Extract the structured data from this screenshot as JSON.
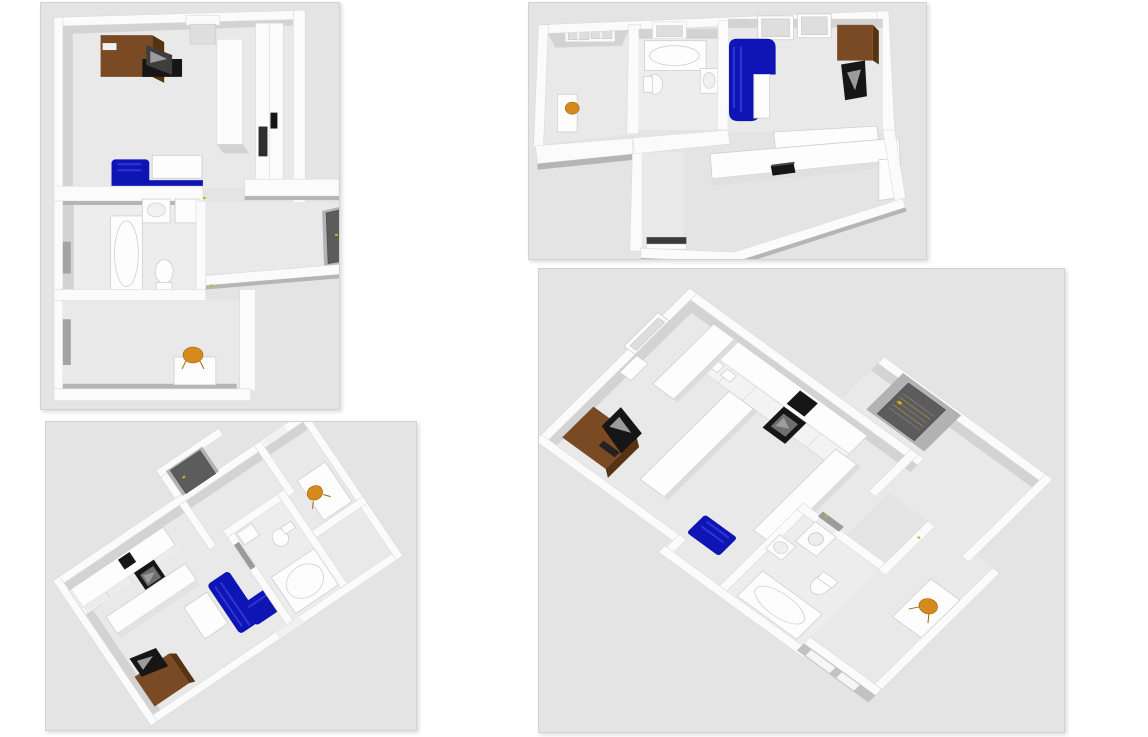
{
  "canvas": {
    "background": "#ffffff"
  },
  "colors": {
    "page_bg": "#ffffff",
    "panel_bg": "#e4e4e4",
    "panel_border": "#d2d2d2",
    "floor": "#e9e9e9",
    "wall": "#fbfbfb",
    "shade": "#d3d3d3",
    "shade_dark": "#b5b5b5",
    "sofa_blue": "#0f14b4",
    "sofa_blue_light": "#2a36d6",
    "wood_brown": "#7a4a24",
    "wood_brown_dark": "#563311",
    "black": "#161616",
    "screen_gray": "#9c9c9c",
    "chair_orange": "#d8891c",
    "door_dark": "#5c5c5c",
    "door_gray": "#9b9b9b",
    "accent_yellow": "#d8b400"
  },
  "panels": [
    {
      "name": "floor-plan-top-left",
      "label": "3D floor plan render, top-down view: office room with desk and computer, wardrobe, blue corner sofa, bathroom with bathtub, sink and toilet, lower room with desk and orange chair",
      "items": [
        "desk",
        "computer-monitor",
        "wardrobe",
        "cabinet-column",
        "blue-corner-sofa",
        "bathtub",
        "sink",
        "washing-machine",
        "toilet",
        "dark-panel-door",
        "desk-with-orange-chair",
        "window"
      ]
    },
    {
      "name": "floor-plan-top-right",
      "label": "3D floor plan render, wide top-down view: bedroom with desk and orange chair, bathroom with bathtub, toilet and sink, living room with blue corner sofa, brown wardrobe and TV, kitchen counters with black laptop, hallway",
      "items": [
        "window",
        "desk-with-orange-chair",
        "bathtub",
        "toilet",
        "sink",
        "blue-corner-sofa",
        "white-table",
        "brown-wardrobe",
        "tv",
        "kitchen-counter",
        "black-laptop",
        "hallway-door"
      ]
    },
    {
      "name": "floor-plan-bottom-left",
      "label": "3D floor plan render, rotated view: kitchen counters with black oven, blue corner sofa with white table, bathroom with bathtub and toilet, office room with desk and orange chair, brown desk with monitor",
      "items": [
        "kitchen-counter",
        "black-oven",
        "blue-corner-sofa",
        "white-table",
        "bathtub",
        "toilet",
        "sink",
        "gray-door",
        "dark-panel-door",
        "desk-with-orange-chair",
        "brown-desk",
        "computer-monitor"
      ]
    },
    {
      "name": "floor-plan-bottom-right",
      "label": "3D floor plan render, large rotated view: brown desk with monitor, kitchen with cabinets, range hood and black oven, room with dark panel door, bathroom with washing machine, sink, toilet and bathtub, blue sofa, office room with desk and orange chair",
      "items": [
        "brown-desk",
        "computer-monitor",
        "kitchen-cabinets",
        "range-hood",
        "black-oven",
        "dark-panel-door",
        "washing-machine",
        "sink",
        "toilet",
        "bathtub",
        "blue-sofa",
        "desk-with-orange-chair",
        "window"
      ]
    }
  ]
}
